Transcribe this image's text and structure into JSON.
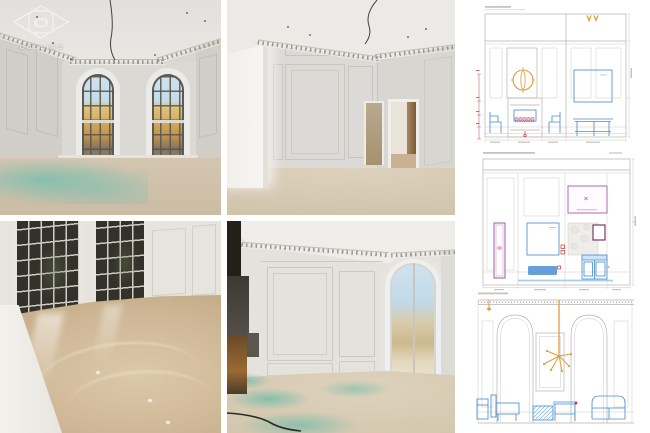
{
  "logo": {
    "brand": "COLLINS",
    "monogram_letter": "C"
  },
  "colors": {
    "page_background": "#ffffff",
    "accent_orange": "#e29b3e",
    "accent_blue": "#4a8fd4",
    "accent_blue_light": "#9cc6e8",
    "accent_pink": "#d84f7e",
    "accent_red": "#cc3333",
    "accent_purple": "#a05aa0",
    "accent_maroon": "#6b2a52",
    "line_gray": "#b5b3ae",
    "teal_screed": "#7fbfae",
    "screed_beige": "#cdbfa9",
    "wall_gray": "#d8d6d1"
  }
}
